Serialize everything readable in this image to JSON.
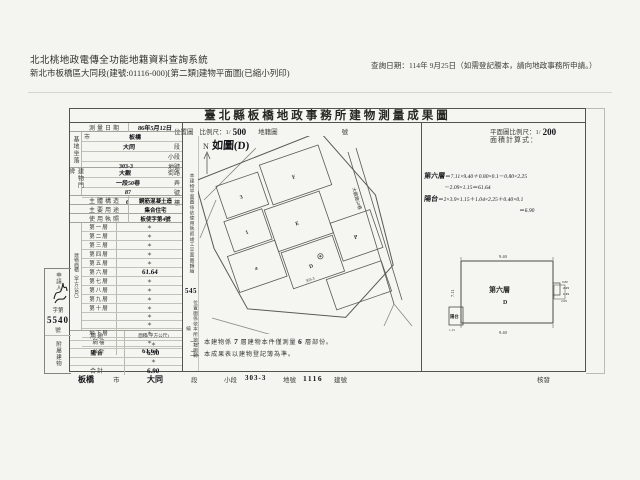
{
  "header": {
    "system_title": "北北桃地政電傳全功能地籍資料查詢系統",
    "subtitle": "新北市板橋區大同段(建號:01116-000)[第二類]建物平面圖(已縮小列印)",
    "query_date": "查詢日期：114年 9月25日（如需登記謄本，請向地政事務所申請。）"
  },
  "form": {
    "title": "臺北縣板橋地政事務所建物測量成果圖",
    "map_band": {
      "loc": "位置圖",
      "scale_pre": "比例尺：1/",
      "scale": "500",
      "cadastral": "地籍圖",
      "num": "號"
    },
    "plan_band": {
      "pre": "平面圖比例尺：1/",
      "scale": "200"
    },
    "calc_label": "面積計算式：",
    "calc": {
      "l1_label": "第六層",
      "l1_body": "＝7.11×9.40＋0.80×0.1－0.80×2.25",
      "l2": "－2.09×1.15＝61.64",
      "l3_label": "陽台",
      "l3_body": "＝2×3.9×1.15＋1.04×2.25＋0.40×0.1",
      "l4": "＝6.90"
    },
    "map": {
      "figure_ref": "如圖(D)",
      "north": "N",
      "road_label": "大觀路50巷",
      "parcel_labels": [
        "3",
        "F",
        "1",
        "E",
        "a",
        "D",
        "P"
      ],
      "subject_label": "303-3"
    },
    "plan": {
      "floor_label": "第六層",
      "unit_label": "D",
      "dim_top": "9.40",
      "dim_bottom": "9.40",
      "dim_left": "7.11",
      "dims_right": [
        "0.80",
        "2.25",
        "1.15",
        "2.09"
      ],
      "balcony_label": "陽台",
      "balcony_dim": "1.15"
    },
    "notes": {
      "n1_pre": "一、本建物係",
      "n1_h1": "7",
      "n1_mid": "層建物本件僅測量",
      "n1_h2": "6",
      "n1_post": "層部份。",
      "n2": "二、本成果表以建物登記簿為準。"
    },
    "strip": {
      "note_top": "本建物平面圖係依使用執照竣工平面圖轉繪",
      "file_no": "545",
      "note_bottom": "位置圖係依本所地籍圖轉繪"
    },
    "applicant": {
      "label": "申請人",
      "file_pre": "字第",
      "file_no": "5540",
      "file_post": "號"
    },
    "table": {
      "survey": {
        "label": "測量日期",
        "value": "86年5月12日"
      },
      "site": {
        "group": "基地坐落",
        "rows": [
          {
            "pre": "市",
            "hand": "板橋",
            "post": ""
          },
          {
            "pre": "",
            "hand": "大同",
            "post": "段"
          },
          {
            "pre": "",
            "hand": "",
            "post": "小段"
          },
          {
            "pre": "",
            "hand": "303-3",
            "post": "地號"
          }
        ]
      },
      "address": {
        "group": "建物門牌",
        "rows": [
          {
            "pre": "",
            "hand": "大觀",
            "post": "街路"
          },
          {
            "pre": "",
            "hand": "一段50巷",
            "post": "弄"
          },
          {
            "pre": "",
            "hand": "87",
            "post": "號"
          },
          {
            "pre": "",
            "hand": "6",
            "post": "樓"
          }
        ]
      },
      "structure": {
        "label": "主體構造",
        "value": "鋼筋混凝土造"
      },
      "usage": {
        "label": "主要用途",
        "value": "集合住宅"
      },
      "license": {
        "label": "使用執照",
        "value": "板使字第4號"
      },
      "floors": {
        "group": "建物面積（平方公尺）",
        "rows": [
          {
            "label": "第一層",
            "value": "＊"
          },
          {
            "label": "第二層",
            "value": "＊"
          },
          {
            "label": "第三層",
            "value": "＊"
          },
          {
            "label": "第四層",
            "value": "＊"
          },
          {
            "label": "第五層",
            "value": "＊"
          },
          {
            "label": "第六層",
            "value": "61.64"
          },
          {
            "label": "第七層",
            "value": "＊"
          },
          {
            "label": "第八層",
            "value": "＊"
          },
          {
            "label": "第九層",
            "value": "＊"
          },
          {
            "label": "第十層",
            "value": "＊"
          },
          {
            "label": "",
            "value": "＊"
          },
          {
            "label": "",
            "value": "＊"
          },
          {
            "label": "地下層",
            "value": "＊"
          },
          {
            "label": "騎樓",
            "value": "＊"
          },
          {
            "label": "合計",
            "value": "61.64"
          }
        ]
      },
      "annex": {
        "group": "附屬建物",
        "header": {
          "label": "用途",
          "value": "面積(平方公尺)"
        },
        "rows": [
          {
            "label": "",
            "value": "＊"
          },
          {
            "label": "陽台",
            "value": "6.90"
          },
          {
            "label": "",
            "value": "＊"
          },
          {
            "label": "合計",
            "value": "6.90"
          }
        ]
      }
    },
    "footer": {
      "city": "板橋",
      "city_suffix": "市",
      "section": "大同",
      "section_suffix": "段",
      "subsection_label": "小段",
      "parcel": "303-3",
      "parcel_label": "地號",
      "building_no": "1116",
      "building_label": "建號",
      "approve": "核發"
    }
  }
}
